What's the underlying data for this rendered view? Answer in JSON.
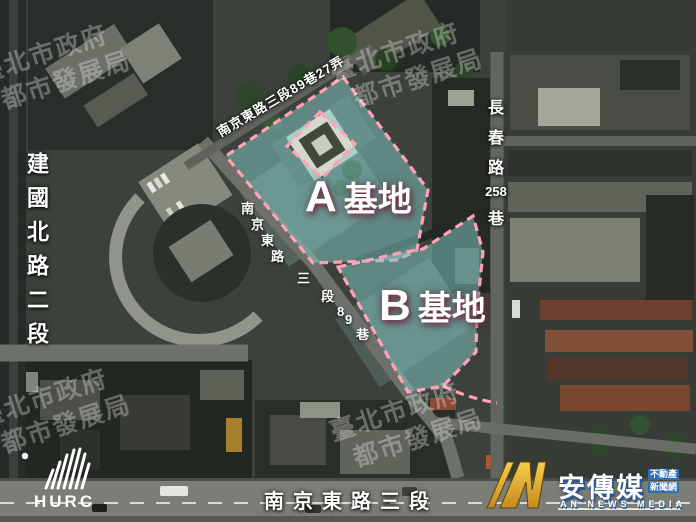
{
  "map": {
    "site_a": {
      "letter": "A",
      "word": "基地"
    },
    "site_b": {
      "letter": "B",
      "word": "基地"
    },
    "streets": {
      "jianguo_north_rd_sec2": "建國北路二段",
      "nanjing_e_sec3_ln89_al27": "南京東路三段89巷27弄",
      "nanjing_e_sec3_ln89": "南京東路三段89巷",
      "changchun_rd_ln258_parts": [
        "長",
        "春",
        "路",
        "258",
        "巷"
      ],
      "nanjing_e_rd_sec3": "南京東路三段"
    },
    "watermark": {
      "line1": "臺北市政府",
      "line2": "都市發展局"
    }
  },
  "branding": {
    "hurc": {
      "label": "HURC"
    },
    "an_media": {
      "name_zh": "安傳媒",
      "tag_top": "不動產",
      "tag_bottom": "新聞網",
      "name_en": "AN NEWS MEDIA"
    }
  },
  "colors": {
    "site_fill": "rgba(128,199,196,0.52)",
    "site_stroke": "#ffa2b5",
    "an_gold_light": "#f6cf4a",
    "an_gold_dark": "#c8891d"
  }
}
